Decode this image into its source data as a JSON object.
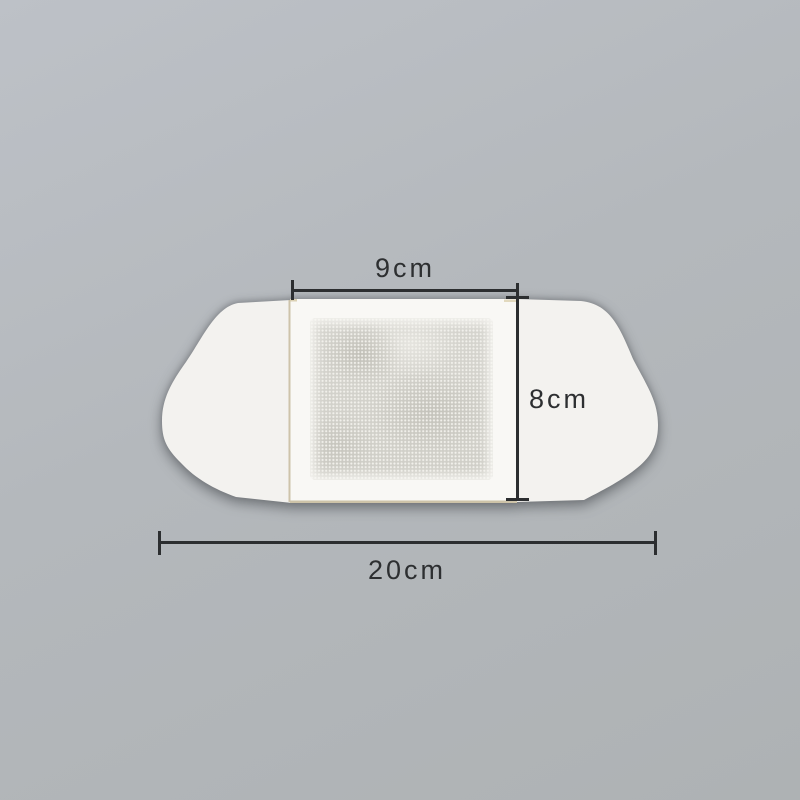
{
  "scene": {
    "description": "Product photo of a white adhesive plaster patch with a grey non-woven absorbent pad, lying on a plain grey background, annotated with size dimension lines"
  },
  "colors": {
    "bg-top": "#bdc1c7",
    "bg-mid": "#b4b8bc",
    "bg-bottom": "#aeb2b4",
    "patch-wing": "#f3f2ef",
    "patch-liner": "#f9f8f5",
    "adhesive-edge": "#c6bb9d",
    "pad-base": "#d3d2cc",
    "dim-line": "#2c2e30",
    "dim-text": "#2d2f31"
  },
  "annotations": {
    "inner_width_label": "9cm",
    "height_label": "8cm",
    "total_width_label": "20cm"
  }
}
